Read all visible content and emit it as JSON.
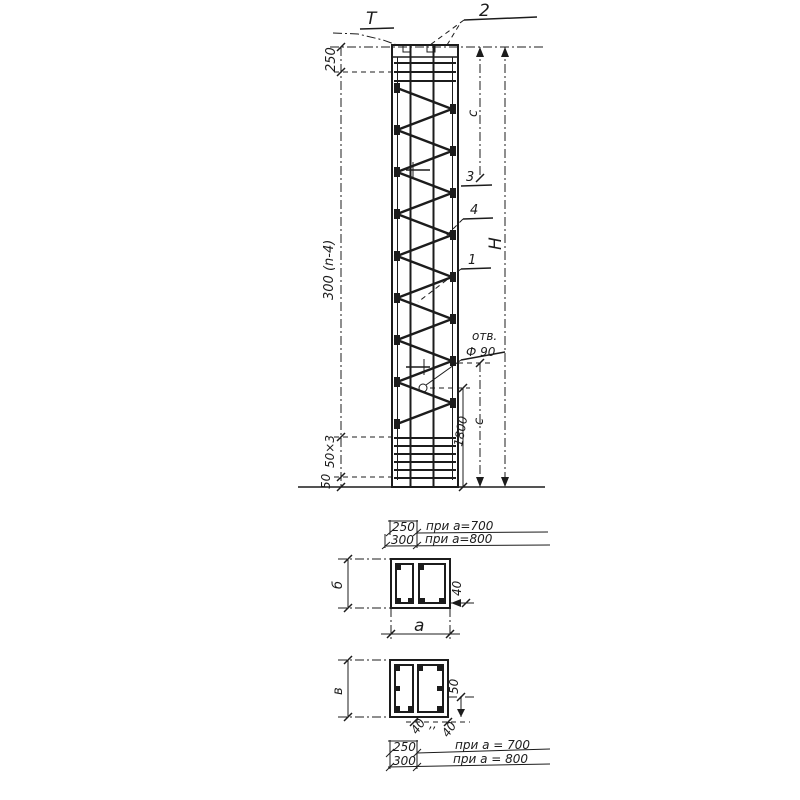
{
  "colors": {
    "ink": "#1c1c1c",
    "paper": "#ffffff"
  },
  "elevation": {
    "section_mark": "Т",
    "callout_top": "2",
    "callout_tie": "3",
    "callout_bar": "4",
    "callout_lattice": "1",
    "hole_note_line1": "отв.",
    "hole_note_line2": "Ф 90",
    "dim_top_250": "250",
    "dim_spacing": "300 (n-4)",
    "dim_base_50x3": "50×3",
    "dim_base_50": "50",
    "dim_c_upper": "c",
    "dim_c_lower": "c",
    "dim_1800": "1800",
    "dim_height": "Н"
  },
  "table_top": {
    "rows": [
      {
        "value": "250",
        "cond": "при a=700"
      },
      {
        "value": "300",
        "cond": "при a=800"
      }
    ]
  },
  "section_upper": {
    "dim_side": "б",
    "dim_a": "a",
    "dim_40": "40"
  },
  "section_lower": {
    "dim_side": "в",
    "dim_50": "50",
    "dim_40_1": "40",
    "dim_ditto": ",,",
    "dim_40_2": "40"
  },
  "table_bottom": {
    "rows": [
      {
        "value": "250",
        "cond": "при a = 700"
      },
      {
        "value": "300",
        "cond": "при a = 800"
      }
    ]
  }
}
